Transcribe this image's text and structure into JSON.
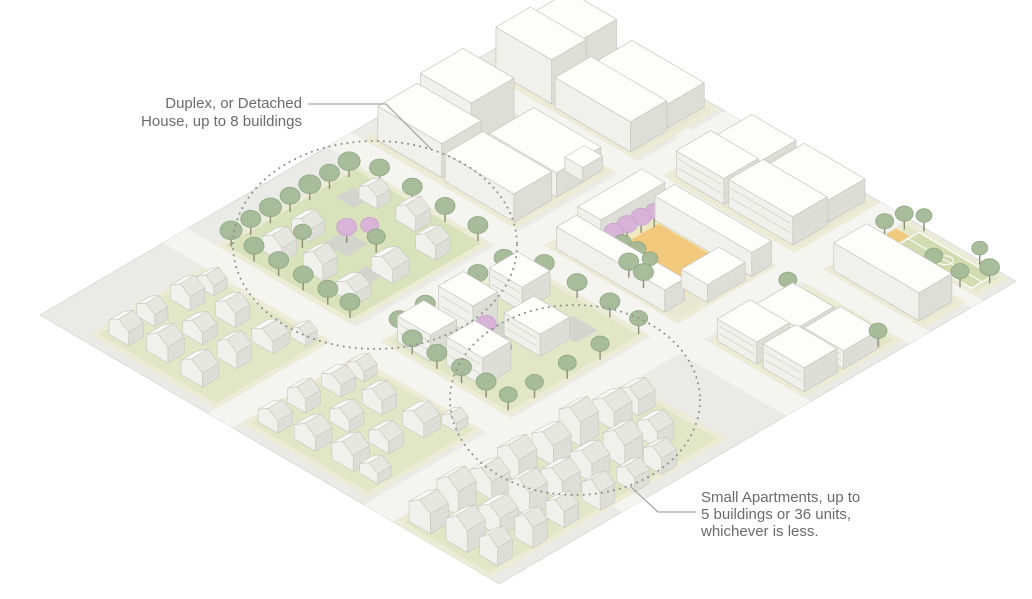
{
  "annotations": {
    "duplex": {
      "lines": [
        "Duplex, or Detached",
        "House, up to 8 buildings"
      ]
    },
    "small_apartments": {
      "lines": [
        "Small Apartments, up to",
        "5 buildings or 36 units,",
        "whichever is less."
      ]
    }
  },
  "palette": {
    "base": "#eaeae6",
    "street": "#f4f4f1",
    "pad": "#ebecd6",
    "ground": "#e7e8d1",
    "lawn": "#e0e6c6",
    "lawn_bright": "#d9e2ba",
    "path": "#d4d4cf",
    "court_orange": "#f2c87d",
    "court_rim": "#efe7bd",
    "bcourt": "#d3dcb0",
    "bcourt_line": "#ffffff",
    "tree": "#a4ba97",
    "tree_edge": "#8ba37f",
    "pink": "#d9b2da",
    "pink_edge": "#c89fca",
    "trunk": "#8d8d74",
    "box_top": "#fdfdfc",
    "box_front": "#f0f0ec",
    "box_side": "#deded8",
    "box_stroke": "#c7c7c0",
    "roof_l": "#f8f8f6",
    "roof_r": "#e7e7e2",
    "window": "#d8d8d2",
    "site_edge": "#dcdcd6",
    "circle_stroke": "#8f8f8f",
    "leader": "#a8a8a8",
    "text": "#6b6b6b"
  },
  "iso": {
    "ox": 40,
    "oy": 315,
    "ax": 0.82,
    "ay": 0.48
  },
  "site": {
    "u": [
      0,
      560
    ],
    "v": [
      0,
      630
    ]
  },
  "streets": [
    {
      "axis": "u",
      "range": [
        205,
        235
      ]
    },
    {
      "axis": "u",
      "range": [
        395,
        430
      ]
    },
    {
      "axis": "v",
      "range": [
        150,
        180
      ]
    },
    {
      "axis": "v",
      "range": [
        350,
        380
      ]
    },
    {
      "axis": "v",
      "range": [
        500,
        525
      ]
    },
    {
      "axis": "v",
      "range": [
        575,
        590
      ]
    }
  ],
  "blocks": [
    {
      "name": "left-houses-lot",
      "rect": [
        50,
        10,
        205,
        150
      ],
      "ground": "lawn",
      "flats": [],
      "items": [
        [
          "H",
          62,
          22,
          24,
          18,
          14,
          7
        ],
        [
          "H",
          60,
          58,
          22,
          16,
          12,
          6
        ],
        [
          "H",
          63,
          96,
          24,
          18,
          14,
          7
        ],
        [
          "H",
          66,
          126,
          20,
          16,
          10,
          6
        ],
        [
          "H",
          102,
          28,
          26,
          20,
          16,
          8
        ],
        [
          "H",
          106,
          68,
          24,
          18,
          12,
          7
        ],
        [
          "H",
          108,
          106,
          24,
          18,
          14,
          7
        ],
        [
          "H",
          148,
          24,
          26,
          20,
          14,
          8
        ],
        [
          "H",
          152,
          64,
          24,
          18,
          16,
          8
        ],
        [
          "H",
          156,
          102,
          26,
          20,
          12,
          7
        ],
        [
          "H",
          176,
          130,
          18,
          14,
          9,
          5
        ]
      ]
    },
    {
      "name": "bottom-left-houses-lot",
      "rect": [
        235,
        10,
        390,
        150
      ],
      "ground": "lawn",
      "flats": [],
      "items": [
        [
          "H",
          244,
          22,
          24,
          18,
          12,
          7
        ],
        [
          "H",
          242,
          60,
          22,
          18,
          14,
          7
        ],
        [
          "H",
          245,
          98,
          24,
          18,
          12,
          6
        ],
        [
          "H",
          247,
          128,
          20,
          16,
          10,
          6
        ],
        [
          "H",
          284,
          26,
          26,
          20,
          14,
          8
        ],
        [
          "H",
          287,
          66,
          24,
          18,
          12,
          7
        ],
        [
          "H",
          289,
          104,
          24,
          18,
          14,
          7
        ],
        [
          "H",
          328,
          28,
          26,
          20,
          16,
          8
        ],
        [
          "H",
          333,
          68,
          24,
          18,
          12,
          7
        ],
        [
          "H",
          336,
          106,
          26,
          20,
          14,
          7
        ],
        [
          "H",
          358,
          132,
          18,
          14,
          9,
          5
        ],
        [
          "H",
          360,
          30,
          22,
          16,
          10,
          6
        ]
      ]
    },
    {
      "name": "bottom-houses-lot",
      "rect": [
        432,
        0,
        548,
        290
      ],
      "ground": "lawn",
      "flats": [],
      "items": [
        [
          "H",
          440,
          10,
          26,
          22,
          20,
          8
        ],
        [
          "H",
          438,
          46,
          26,
          22,
          24,
          9
        ],
        [
          "H",
          442,
          83,
          26,
          22,
          18,
          8
        ],
        [
          "H",
          440,
          118,
          26,
          22,
          22,
          9
        ],
        [
          "H",
          444,
          156,
          26,
          22,
          20,
          8
        ],
        [
          "H",
          440,
          193,
          26,
          22,
          24,
          9
        ],
        [
          "H",
          444,
          230,
          26,
          22,
          18,
          8
        ],
        [
          "H",
          446,
          260,
          24,
          20,
          16,
          7
        ],
        [
          "H",
          482,
          13,
          26,
          22,
          22,
          9
        ],
        [
          "H",
          485,
          50,
          26,
          22,
          18,
          8
        ],
        [
          "H",
          483,
          88,
          26,
          22,
          24,
          9
        ],
        [
          "H",
          487,
          124,
          26,
          22,
          20,
          8
        ],
        [
          "H",
          485,
          162,
          26,
          22,
          18,
          8
        ],
        [
          "H",
          489,
          198,
          26,
          22,
          22,
          9
        ],
        [
          "H",
          491,
          238,
          24,
          20,
          16,
          7
        ],
        [
          "H",
          518,
          18,
          22,
          18,
          18,
          8
        ],
        [
          "H",
          521,
          58,
          22,
          18,
          20,
          8
        ],
        [
          "H",
          519,
          98,
          22,
          18,
          16,
          7
        ],
        [
          "H",
          523,
          138,
          22,
          18,
          18,
          8
        ],
        [
          "H",
          525,
          178,
          22,
          18,
          14,
          7
        ],
        [
          "H",
          523,
          213,
          22,
          18,
          16,
          7
        ]
      ]
    },
    {
      "name": "duplex-block",
      "rect": [
        35,
        180,
        200,
        350
      ],
      "ground": "lawn_bright",
      "flats": [
        [
          "path",
          98,
          248,
          28,
          26
        ],
        [
          "path",
          58,
          303,
          22,
          20
        ],
        [
          "path",
          148,
          228,
          20,
          22
        ]
      ],
      "items": [
        [
          "H",
          68,
          203,
          24,
          18,
          14,
          7
        ],
        [
          "H",
          66,
          241,
          22,
          18,
          12,
          6
        ],
        [
          "H",
          73,
          316,
          22,
          16,
          12,
          6
        ],
        [
          "H",
          113,
          208,
          24,
          18,
          16,
          8
        ],
        [
          "H",
          118,
          316,
          24,
          18,
          14,
          7
        ],
        [
          "H",
          158,
          203,
          24,
          18,
          12,
          6
        ],
        [
          "H",
          156,
          248,
          26,
          20,
          14,
          7
        ],
        [
          "H",
          160,
          298,
          24,
          18,
          14,
          7
        ],
        [
          "P",
          112,
          262,
          10
        ],
        [
          "P",
          124,
          278,
          9
        ],
        [
          "T",
          45,
          188,
          11
        ],
        [
          "T",
          45,
          212,
          10
        ],
        [
          "T",
          45,
          236,
          11
        ],
        [
          "T",
          45,
          260,
          10
        ],
        [
          "T",
          45,
          284,
          11
        ],
        [
          "T",
          45,
          308,
          10
        ],
        [
          "T",
          45,
          332,
          11
        ],
        [
          "T",
          75,
          186,
          10
        ],
        [
          "T",
          105,
          186,
          10
        ],
        [
          "T",
          135,
          186,
          10
        ],
        [
          "T",
          165,
          186,
          10
        ],
        [
          "T",
          192,
          186,
          10
        ],
        [
          "T",
          70,
          344,
          10
        ],
        [
          "T",
          110,
          344,
          10
        ],
        [
          "T",
          150,
          344,
          10
        ],
        [
          "T",
          190,
          344,
          10
        ],
        [
          "T",
          140,
          270,
          9
        ],
        [
          "T",
          90,
          230,
          9
        ]
      ]
    },
    {
      "name": "small-apartments-block",
      "rect": [
        235,
        180,
        392,
        350
      ],
      "ground": "lawn",
      "flats": [
        [
          "path",
          282,
          232,
          26,
          40
        ],
        [
          "path",
          326,
          298,
          30,
          26
        ]
      ],
      "items": [
        [
          "A",
          246,
          190,
          40,
          32,
          26
        ],
        [
          "A",
          244,
          242,
          42,
          30,
          30
        ],
        [
          "A",
          250,
          298,
          40,
          34,
          24
        ],
        [
          "A",
          300,
          196,
          44,
          34,
          28
        ],
        [
          "A",
          304,
          262,
          44,
          36,
          22
        ],
        [
          "P",
          298,
          246,
          10
        ],
        [
          "T",
          240,
          198,
          10
        ],
        [
          "T",
          240,
          230,
          10
        ],
        [
          "T",
          240,
          262,
          10
        ],
        [
          "T",
          240,
          294,
          10
        ],
        [
          "T",
          240,
          326,
          10
        ],
        [
          "T",
          268,
          186,
          10
        ],
        [
          "T",
          298,
          186,
          10
        ],
        [
          "T",
          328,
          186,
          10
        ],
        [
          "T",
          358,
          186,
          10
        ],
        [
          "T",
          385,
          186,
          9
        ],
        [
          "T",
          270,
          345,
          10
        ],
        [
          "T",
          310,
          345,
          10
        ],
        [
          "T",
          350,
          345,
          10
        ],
        [
          "T",
          385,
          345,
          9
        ],
        [
          "T",
          388,
          215,
          9
        ],
        [
          "T",
          388,
          255,
          9
        ],
        [
          "T",
          388,
          295,
          9
        ],
        [
          "T",
          332,
          232,
          9
        ],
        [
          "T",
          275,
          322,
          9
        ]
      ]
    },
    {
      "name": "commercial-block-a",
      "rect": [
        15,
        380,
        200,
        500
      ],
      "ground": "ground",
      "flats": [],
      "items": [
        [
          "B",
          24,
          388,
          78,
          48,
          34
        ],
        [
          "B",
          24,
          440,
          62,
          52,
          42
        ],
        [
          "B",
          108,
          386,
          84,
          46,
          28
        ],
        [
          "B",
          110,
          438,
          82,
          54,
          24
        ],
        [
          "B",
          170,
          470,
          22,
          24,
          14
        ]
      ]
    },
    {
      "name": "commercial-block-b",
      "rect": [
        15,
        525,
        200,
        628
      ],
      "ground": "ground",
      "flats": [],
      "items": [
        [
          "B",
          24,
          532,
          68,
          42,
          44
        ],
        [
          "B",
          23,
          578,
          58,
          44,
          36
        ],
        [
          "B",
          98,
          530,
          92,
          44,
          30
        ],
        [
          "B",
          100,
          578,
          88,
          44,
          24
        ]
      ]
    },
    {
      "name": "north-apartments-block",
      "rect": [
        235,
        525,
        395,
        628
      ],
      "ground": "ground",
      "flats": [],
      "items": [
        [
          "A",
          244,
          532,
          58,
          42,
          26
        ],
        [
          "A",
          246,
          578,
          54,
          44,
          20
        ],
        [
          "A",
          308,
          532,
          78,
          42,
          28
        ],
        [
          "A",
          310,
          578,
          74,
          44,
          22
        ]
      ]
    },
    {
      "name": "courtyard-block",
      "rect": [
        235,
        380,
        398,
        500
      ],
      "ground": "ground",
      "flats": [
        [
          "courtrim",
          276,
          404,
          98,
          74
        ],
        [
          "court",
          282,
          410,
          86,
          62
        ]
      ],
      "items": [
        [
          "B",
          246,
          384,
          132,
          24,
          22
        ],
        [
          "B",
          242,
          414,
          28,
          78,
          26
        ],
        [
          "B",
          276,
          474,
          118,
          24,
          24
        ],
        [
          "B",
          362,
          420,
          32,
          46,
          18
        ],
        [
          "P",
          280,
          420,
          10
        ],
        [
          "P",
          280,
          436,
          10
        ],
        [
          "P",
          281,
          452,
          10
        ],
        [
          "P",
          283,
          466,
          9
        ],
        [
          "T",
          300,
          396,
          10
        ],
        [
          "T",
          320,
          398,
          10
        ],
        [
          "T",
          340,
          396,
          10
        ],
        [
          "T",
          296,
          414,
          9
        ],
        [
          "T",
          312,
          416,
          9
        ],
        [
          "T",
          330,
          414,
          8
        ]
      ]
    },
    {
      "name": "south-apartments-block",
      "rect": [
        435,
        380,
        552,
        500
      ],
      "ground": "lawn",
      "flats": [],
      "items": [
        [
          "A",
          440,
          386,
          48,
          40,
          22
        ],
        [
          "A",
          442,
          432,
          50,
          44,
          16
        ],
        [
          "A",
          496,
          386,
          50,
          40,
          24
        ],
        [
          "A",
          498,
          434,
          48,
          44,
          18
        ],
        [
          "T",
          436,
          476,
          9
        ],
        [
          "T",
          544,
          478,
          9
        ]
      ]
    },
    {
      "name": "school-block",
      "rect": [
        430,
        525,
        552,
        578
      ],
      "ground": "ground",
      "flats": [],
      "items": [
        [
          "B",
          438,
          530,
          104,
          40,
          28
        ]
      ]
    },
    {
      "name": "park-block",
      "rect": [
        430,
        590,
        552,
        628
      ],
      "ground": "lawn",
      "flats": [
        [
          "court",
          432,
          592,
          16,
          20
        ],
        [
          "bcourt",
          450,
          596,
          90,
          26
        ]
      ],
      "items": [
        [
          "T",
          434,
          596,
          9
        ],
        [
          "T",
          438,
          616,
          9
        ],
        [
          "T",
          452,
          626,
          8
        ],
        [
          "T",
          500,
          590,
          9
        ],
        [
          "T",
          532,
          590,
          9
        ],
        [
          "T",
          546,
          612,
          10
        ],
        [
          "T",
          520,
          626,
          8
        ]
      ]
    }
  ],
  "circles": [
    {
      "cx": 375,
      "cy": 245,
      "rx": 142,
      "ry": 104
    },
    {
      "cx": 575,
      "cy": 400,
      "rx": 125,
      "ry": 95
    }
  ],
  "leaders": [
    [
      [
        308,
        104
      ],
      [
        386,
        104
      ],
      [
        431,
        149
      ]
    ],
    [
      [
        630,
        486
      ],
      [
        658,
        512
      ],
      [
        696,
        512
      ]
    ]
  ]
}
